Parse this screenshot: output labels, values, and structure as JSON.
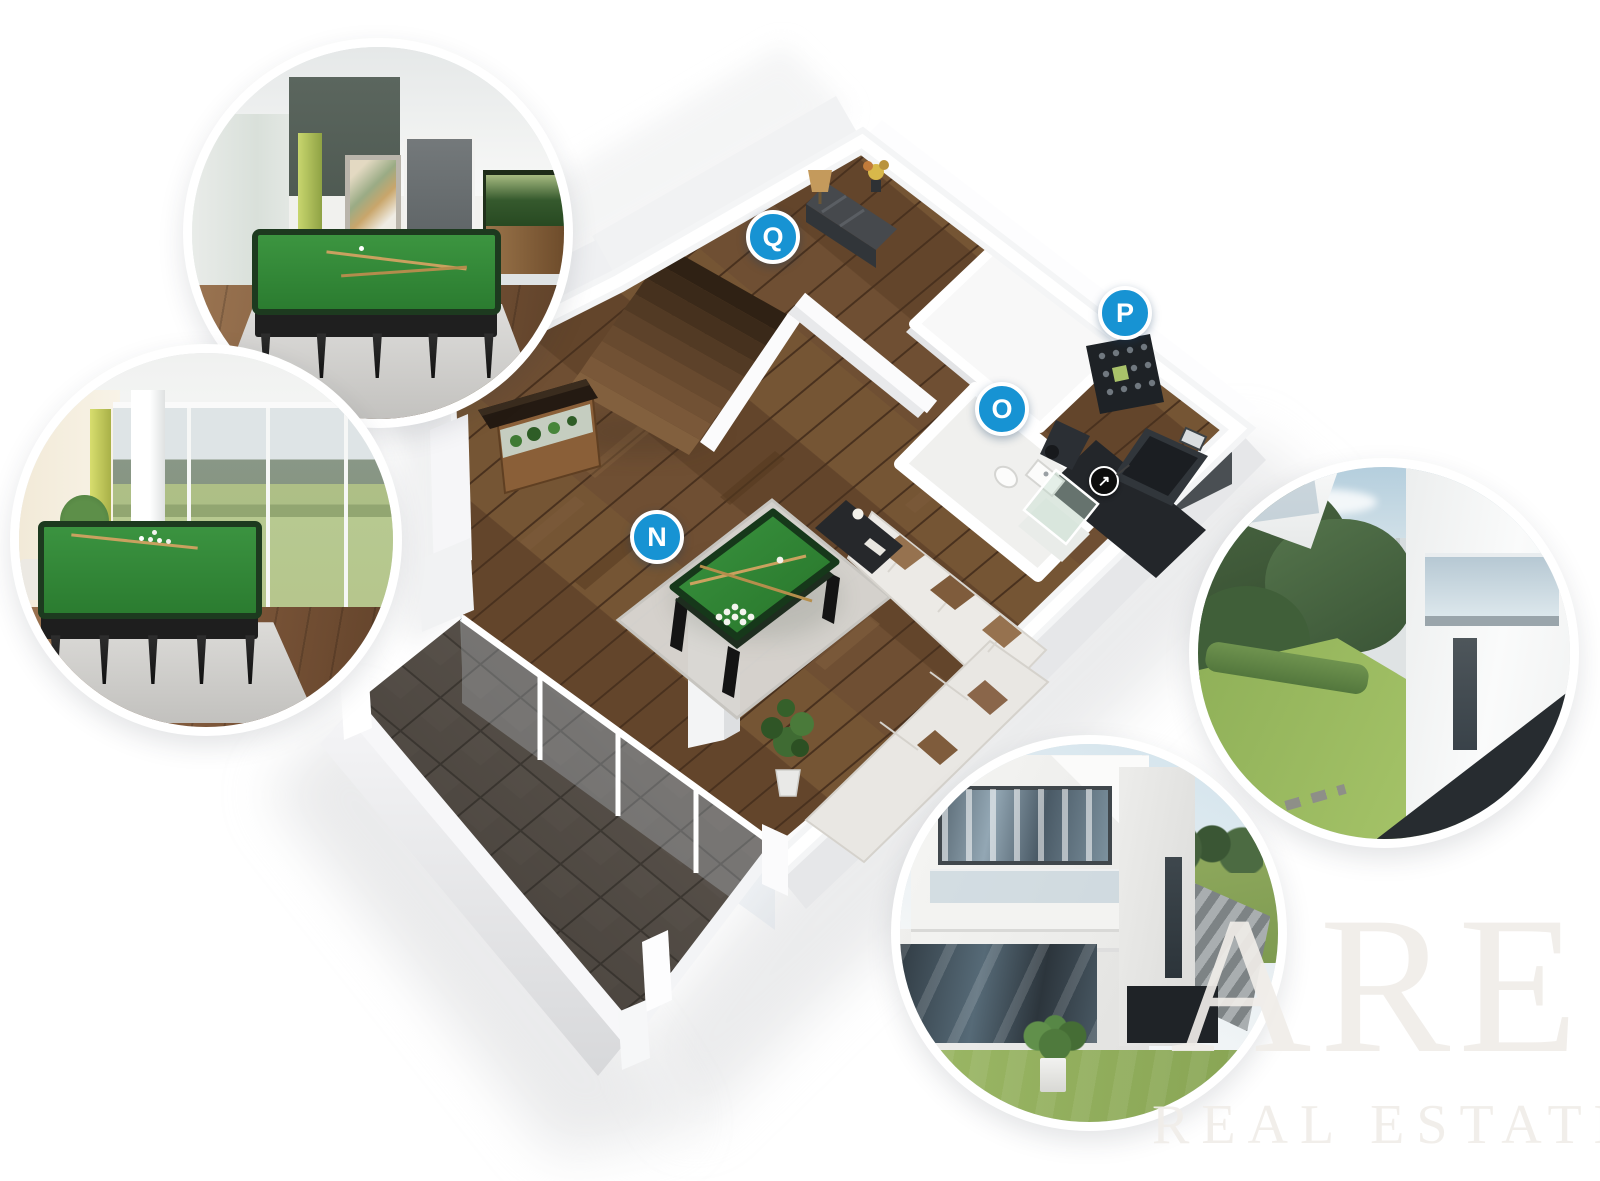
{
  "page": {
    "background": "#ffffff"
  },
  "floor_plan": {
    "markers": [
      {
        "label": "N",
        "x": 657,
        "y": 537
      },
      {
        "label": "O",
        "x": 1002,
        "y": 409
      },
      {
        "label": "P",
        "x": 1125,
        "y": 313
      },
      {
        "label": "Q",
        "x": 773,
        "y": 237
      }
    ],
    "marker_color": "#1793d3",
    "camera_icon": {
      "glyph": "↗",
      "x": 1104,
      "y": 481
    },
    "colors": {
      "wood_floor": "#6b4b30",
      "terrace_tile": "#565049",
      "billiard_felt": "#2f8033",
      "wall": "#fafafb",
      "rug": "#d7d5d1"
    }
  },
  "watermark": {
    "line1": "ARE",
    "line2": "REAL ESTATE",
    "color": "rgba(240,237,232,0.92)"
  }
}
